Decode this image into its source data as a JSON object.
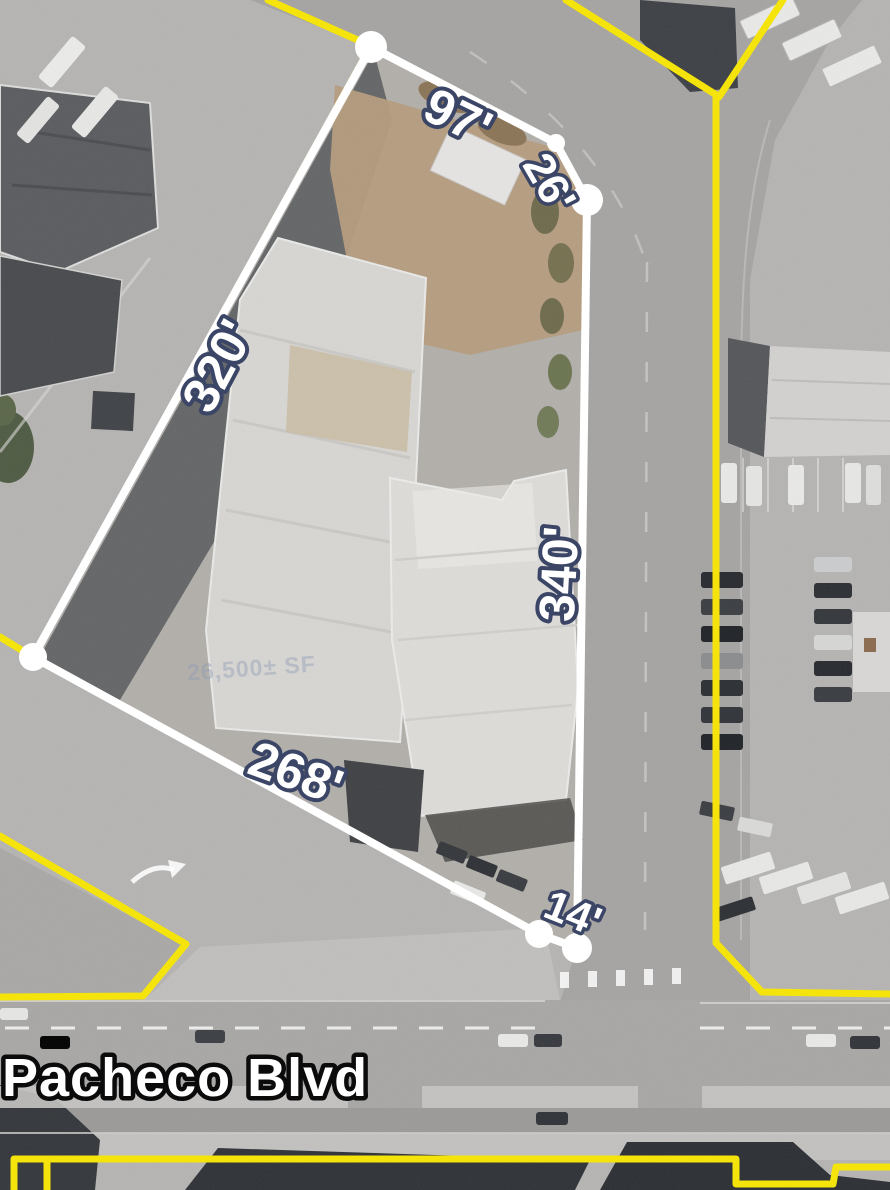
{
  "map": {
    "street_label": "Pacheco Blvd",
    "building_area_label": "26,500± SF",
    "measurements": [
      {
        "side": "north",
        "label": "97'"
      },
      {
        "side": "northeast",
        "label": "26'"
      },
      {
        "side": "northwest",
        "label": "320'"
      },
      {
        "side": "east",
        "label": "340'"
      },
      {
        "side": "south",
        "label": "268'"
      },
      {
        "side": "southeast",
        "label": "14'"
      }
    ],
    "colors": {
      "parcel_line": "#ffffff",
      "boundary_line": "#f4e40c",
      "label_fill": "#ffffff",
      "label_outline": "#3b4566",
      "street_label_fill": "#ffffff",
      "street_label_outline": "#0b0b0b"
    }
  }
}
